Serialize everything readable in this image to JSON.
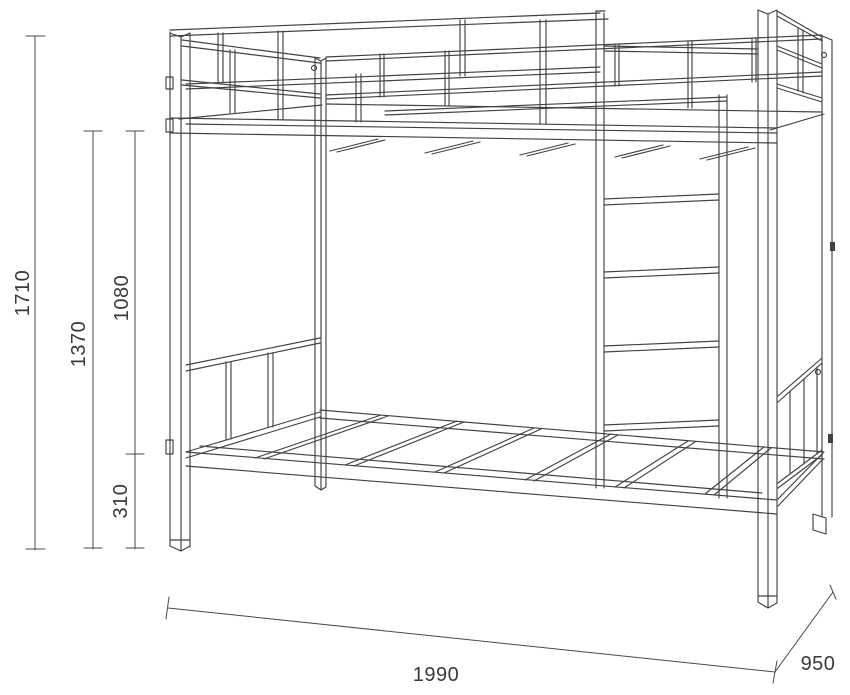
{
  "canvas": {
    "background": "#ffffff",
    "drawing_line_color": "#424242",
    "dimension_line_color": "#4a4a4a",
    "text_color": "#3a3a3a"
  },
  "drawing": {
    "subject": "bunk bed frame technical dimension drawing",
    "dimensions": {
      "overall_height": "1710",
      "floor_to_upper_bed": "1370",
      "lower_bed_to_upper_bed": "1080",
      "floor_to_lower_bed": "310",
      "bed_length": "1990",
      "bed_width": "950"
    }
  }
}
